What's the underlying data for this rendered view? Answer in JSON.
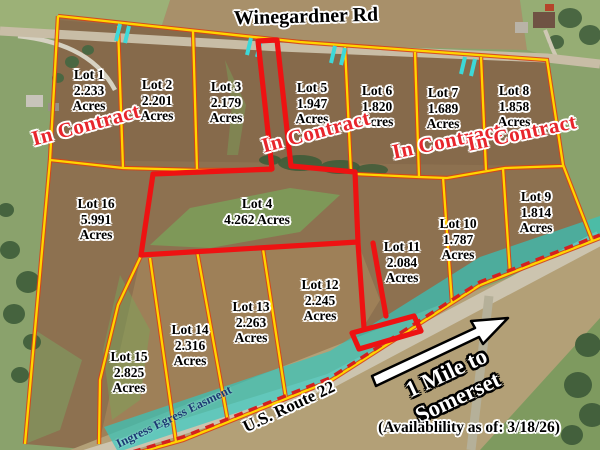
{
  "map": {
    "title": "Winegardner Rd lot availability plat map",
    "roads": {
      "top_road": "Winegardner Rd",
      "bottom_road": "U.S. Route 22"
    },
    "easement_label": "Ingress Egress Easment",
    "arrow": {
      "line1": "1 Mile to",
      "line2": "Somerset"
    },
    "availability_note": "(Availablility as of: 3/18/26)",
    "status_labels": [
      "In Contract",
      "In Contract",
      "In Contract",
      "In Contract"
    ],
    "lots": [
      {
        "name": "Lot 1",
        "acres": "2.233",
        "unit": "Acres"
      },
      {
        "name": "Lot 2",
        "acres": "2.201",
        "unit": "Acres"
      },
      {
        "name": "Lot 3",
        "acres": "2.179",
        "unit": "Acres"
      },
      {
        "name": "Lot 4",
        "acres": "4.262 Acres",
        "unit": ""
      },
      {
        "name": "Lot 5",
        "acres": "1.947",
        "unit": "Acres"
      },
      {
        "name": "Lot 6",
        "acres": "1.820",
        "unit": "Acres"
      },
      {
        "name": "Lot 7",
        "acres": "1.689",
        "unit": "Acres"
      },
      {
        "name": "Lot 8",
        "acres": "1.858",
        "unit": "Acres"
      },
      {
        "name": "Lot 9",
        "acres": "1.814",
        "unit": "Acres"
      },
      {
        "name": "Lot 10",
        "acres": "1.787",
        "unit": "Acres"
      },
      {
        "name": "Lot 11",
        "acres": "2.084",
        "unit": "Acres"
      },
      {
        "name": "Lot 12",
        "acres": "2.245",
        "unit": "Acres"
      },
      {
        "name": "Lot 13",
        "acres": "2.263",
        "unit": "Acres"
      },
      {
        "name": "Lot 14",
        "acres": "2.316",
        "unit": "Acres"
      },
      {
        "name": "Lot 15",
        "acres": "2.825",
        "unit": "Acres"
      },
      {
        "name": "Lot 16",
        "acres": "5.991",
        "unit": "Acres"
      }
    ],
    "colors": {
      "lot_line": "#FFD400",
      "lot_line_casing": "#D84315",
      "highlight": "#EE1212",
      "easement": "#2FC9C1",
      "dashed_line": "#D42020",
      "tick": "#3DD8D8",
      "contract_text": "#E8262D"
    }
  }
}
